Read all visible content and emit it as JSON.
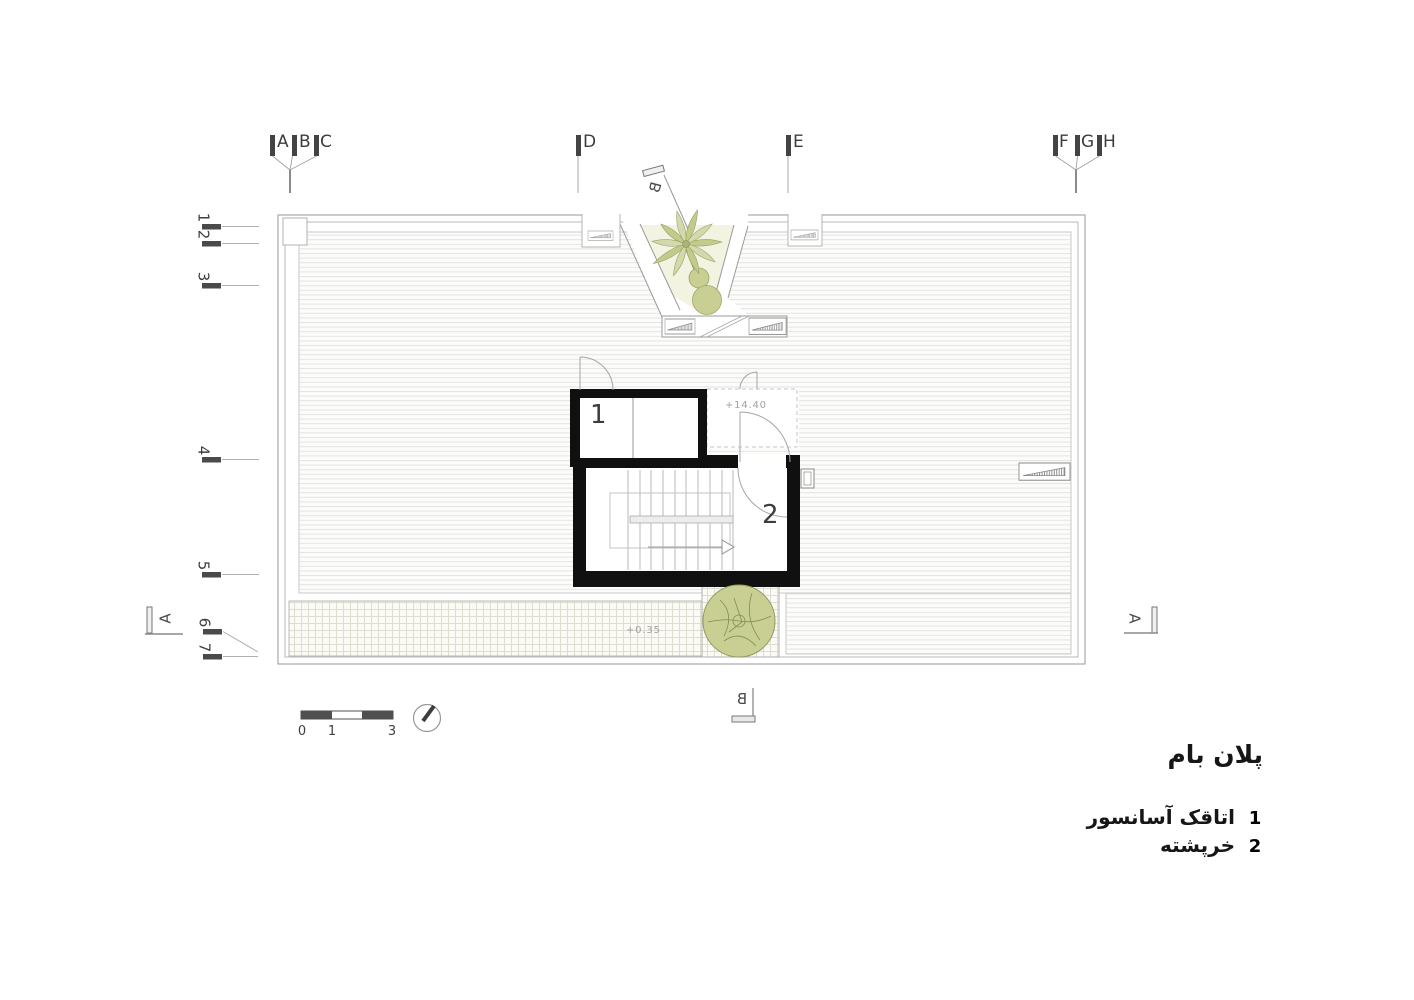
{
  "plan": {
    "grid_letters": [
      "A",
      "B",
      "C",
      "D",
      "E",
      "F",
      "G",
      "H"
    ],
    "row_numbers": [
      "1",
      "2",
      "3",
      "4",
      "5",
      "6",
      "7"
    ],
    "section_markers": {
      "left": "A",
      "right": "A",
      "top": "B",
      "bottom": "B"
    },
    "levels": {
      "penthouse_roof": "+14.40",
      "roof_terrace": "+0.35"
    },
    "room_labels": {
      "elevator_cab": "1",
      "stair_penthouse": "2"
    }
  },
  "scale_bar": {
    "labels": [
      "0",
      "1",
      "3"
    ]
  },
  "titleblock": {
    "title": "پلان بام",
    "legend": [
      {
        "num": "1",
        "label": "اتاقک آسانسور"
      },
      {
        "num": "2",
        "label": "خرپشته"
      }
    ]
  }
}
